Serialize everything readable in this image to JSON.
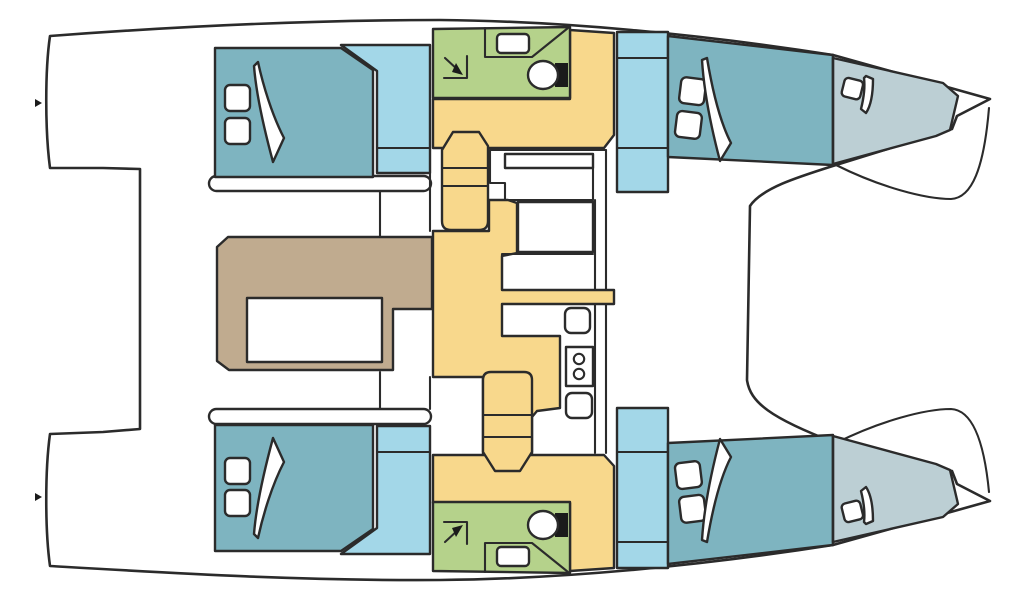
{
  "diagram": {
    "title": "Catamaran interior layout floor plan, bow to the right",
    "type": "boat-floor-plan",
    "orientation": "bow-right",
    "colors": {
      "line": "#2b2b2b",
      "hull": "#ffffff",
      "cabin": "#7eb4c0",
      "window": "#a3d7e8",
      "berth": "#bccfd4",
      "bathroom": "#b5d28b",
      "floor": "#f8d88c",
      "dinette": "#c0ab8f",
      "fixture": "#1b1b1b"
    },
    "rooms": [
      {
        "name": "port-aft-cabin",
        "kind": "double-berth-cabin",
        "color": "cabin"
      },
      {
        "name": "port-head",
        "kind": "bathroom-with-shower",
        "color": "bathroom"
      },
      {
        "name": "port-fwd-cabin",
        "kind": "double-berth-cabin",
        "color": "cabin"
      },
      {
        "name": "port-bow-berth",
        "kind": "bow-crew-berth",
        "color": "berth"
      },
      {
        "name": "starboard-aft-cabin",
        "kind": "double-berth-cabin",
        "color": "cabin"
      },
      {
        "name": "starboard-head",
        "kind": "bathroom-with-shower",
        "color": "bathroom"
      },
      {
        "name": "starboard-fwd-cabin",
        "kind": "double-berth-cabin",
        "color": "cabin"
      },
      {
        "name": "starboard-bow-berth",
        "kind": "bow-crew-berth",
        "color": "berth"
      },
      {
        "name": "salon-dinette",
        "kind": "u-shaped-seating-with-table",
        "color": "dinette"
      },
      {
        "name": "galley-corridor",
        "kind": "galley-and-walkway",
        "color": "floor"
      },
      {
        "name": "aft-platform",
        "kind": "stern-platform",
        "color": "hull"
      },
      {
        "name": "foredeck-trampoline",
        "kind": "trampoline",
        "color": "hull"
      }
    ],
    "fixtures": [
      "bed-pillows",
      "bed-blanket",
      "shower-drain-arrow",
      "wash-basin",
      "toilet",
      "companionway-stairs",
      "galley-sink",
      "two-burner-stove",
      "oven",
      "dinette-table",
      "bow-divider-bulkhead"
    ]
  }
}
